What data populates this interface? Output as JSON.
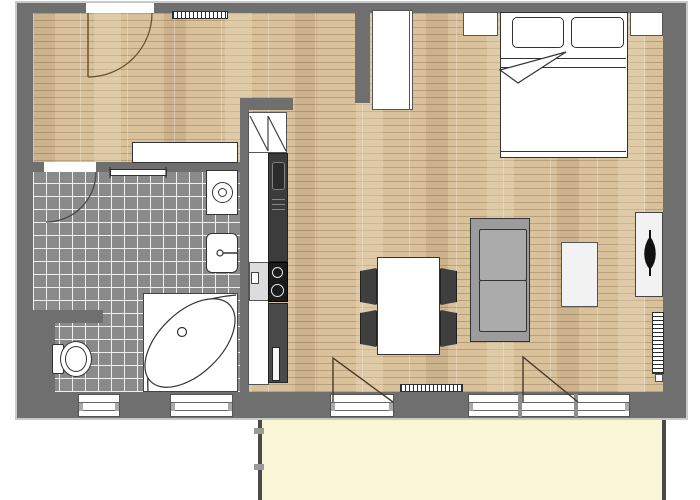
{
  "title": "apartment-floor-plan",
  "colors": {
    "wall": "#6f6f6f",
    "wall-outline": "#c9c9c9",
    "wood": "#d9c19c",
    "tile": "#8a8a8a",
    "balcony": "#f9f6d6",
    "fixture-white": "#ffffff",
    "line": "#333333",
    "sofa": "#ababab",
    "sofa-frame": "#9c9c9c",
    "chair": "#3f3f3f",
    "appliance-dark": "#3c3c3c",
    "cooktop": "#1b1b1b",
    "counter": "#dcdcdc",
    "exterior": "#ffffff"
  },
  "legend": {
    "rooms": [
      "hall",
      "bathroom",
      "kitchen",
      "living-room",
      "bedroom-area",
      "balcony"
    ],
    "fixtures": [
      "entry-door",
      "bathroom-door",
      "towel-rail",
      "washing-machine",
      "bathroom-sink",
      "toilet",
      "corner-bathtub",
      "kitchen-tall-cabinet",
      "oven",
      "cooktop",
      "kitchen-counter",
      "hall-radiator",
      "living-room-radiator",
      "bedroom-radiator",
      "balcony-door-left",
      "balcony-door-right",
      "window"
    ],
    "furniture": [
      "hall-sideboard",
      "wardrobe",
      "double-bed",
      "nightstand-left",
      "nightstand-right",
      "dining-table",
      "dining-chair",
      "sofa",
      "coffee-table",
      "tv-sideboard",
      "tv"
    ]
  }
}
